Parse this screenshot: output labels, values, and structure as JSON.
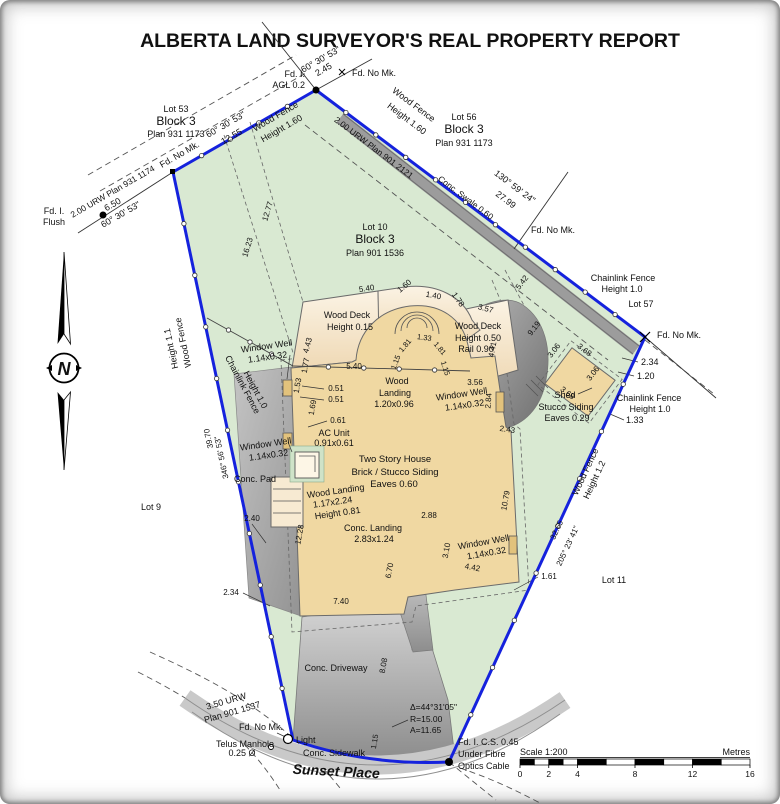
{
  "title": "ALBERTA LAND SURVEYOR'S REAL PROPERTY REPORT",
  "north_arrow": {
    "letter": "N"
  },
  "scale_bar": {
    "label": "Scale 1:200",
    "units": "Metres",
    "ticks": [
      {
        "label": "0",
        "m": 0
      },
      {
        "label": "2",
        "m": 2
      },
      {
        "label": "4",
        "m": 4
      },
      {
        "label": "8",
        "m": 8
      },
      {
        "label": "12",
        "m": 12
      },
      {
        "label": "16",
        "m": 16
      }
    ]
  },
  "colors": {
    "boundary_blue": "#1522dd",
    "parcel_green": "#d9e9d2",
    "house_tan": "#f0d8a2",
    "deck_tan": "#f7ead2",
    "window_well_tan": "#e2c27c",
    "concrete_gray": "#b9b9b9",
    "swale_gray": "#9c9c9c"
  },
  "labels": [
    {
      "id": "fd-i-agl-1",
      "text": "Fd. I.",
      "x": 305,
      "y": 77,
      "anchor": "end"
    },
    {
      "id": "fd-i-agl-2",
      "text": "AGL 0.2",
      "x": 305,
      "y": 88,
      "anchor": "end"
    },
    {
      "id": "tie-bearing",
      "text": "60° 30' 53\"",
      "x": 322,
      "y": 62,
      "rot": -30
    },
    {
      "id": "tie-dist",
      "text": "2.45",
      "x": 325,
      "y": 72,
      "rot": -30
    },
    {
      "id": "fd-no-mk-top",
      "text": "Fd. No Mk.",
      "x": 352,
      "y": 76,
      "anchor": "start"
    },
    {
      "id": "lot53-name",
      "text": "Lot 53",
      "x": 176,
      "y": 112
    },
    {
      "id": "lot53-block",
      "text": "Block 3",
      "x": 176,
      "y": 125,
      "size": 12
    },
    {
      "id": "lot53-plan",
      "text": "Plan 931 1173",
      "x": 176,
      "y": 137
    },
    {
      "id": "nw-bearing",
      "text": "60° 30' 53\"",
      "x": 227,
      "y": 127,
      "rot": -30
    },
    {
      "id": "nw-dist",
      "text": "12.55",
      "x": 233,
      "y": 139,
      "rot": -30
    },
    {
      "id": "nw-wood-fence-1",
      "text": "Wood Fence",
      "x": 277,
      "y": 119,
      "rot": -30
    },
    {
      "id": "nw-wood-fence-2",
      "text": "Height 1.60",
      "x": 283,
      "y": 131,
      "rot": -30
    },
    {
      "id": "urw-nw",
      "text": "2.00 URW Plan 931 1174",
      "x": 114,
      "y": 194,
      "rot": -30,
      "size": 8.5
    },
    {
      "id": "fd-no-mk-w",
      "text": "Fd. No Mk.",
      "x": 181,
      "y": 157,
      "rot": -30
    },
    {
      "id": "ext-dist",
      "text": "6.50",
      "x": 114,
      "y": 207,
      "rot": -30
    },
    {
      "id": "ext-bearing",
      "text": "60° 30' 53\"",
      "x": 122,
      "y": 217,
      "rot": -30
    },
    {
      "id": "fd-i-flush-1",
      "text": "Fd. I.",
      "x": 54,
      "y": 214
    },
    {
      "id": "fd-i-flush-2",
      "text": "Flush",
      "x": 54,
      "y": 225
    },
    {
      "id": "urw-ne",
      "text": "2.00 URW Plan 901 2121",
      "x": 372,
      "y": 150,
      "rot": 37,
      "size": 8.5
    },
    {
      "id": "ne-wood-fence-1",
      "text": "Wood Fence",
      "x": 412,
      "y": 107,
      "rot": 37
    },
    {
      "id": "ne-wood-fence-2",
      "text": "Height 1.60",
      "x": 405,
      "y": 121,
      "rot": 37
    },
    {
      "id": "lot56-name",
      "text": "Lot 56",
      "x": 464,
      "y": 120
    },
    {
      "id": "lot56-block",
      "text": "Block 3",
      "x": 464,
      "y": 133,
      "size": 12
    },
    {
      "id": "lot56-plan",
      "text": "Plan 931 1173",
      "x": 464,
      "y": 146
    },
    {
      "id": "swale-label",
      "text": "Conc. Swale 0.60",
      "x": 464,
      "y": 200,
      "rot": 37,
      "size": 8.5
    },
    {
      "id": "ne-bearing",
      "text": "130° 59' 24\"",
      "x": 513,
      "y": 189,
      "rot": 37
    },
    {
      "id": "ne-dist",
      "text": "27.99",
      "x": 504,
      "y": 202,
      "rot": 37
    },
    {
      "id": "fd-no-mk-5657",
      "text": "Fd. No Mk.",
      "x": 531,
      "y": 233,
      "anchor": "start"
    },
    {
      "id": "clf-ne-1",
      "text": "Chainlink Fence",
      "x": 623,
      "y": 281
    },
    {
      "id": "clf-ne-2",
      "text": "Height 1.0",
      "x": 622,
      "y": 292
    },
    {
      "id": "lot57",
      "text": "Lot 57",
      "x": 641,
      "y": 307
    },
    {
      "id": "fd-no-mk-e",
      "text": "Fd. No Mk.",
      "x": 657,
      "y": 338,
      "anchor": "start"
    },
    {
      "id": "dim-234e",
      "text": "2.34",
      "x": 641,
      "y": 365,
      "anchor": "start"
    },
    {
      "id": "dim-120",
      "text": "1.20",
      "x": 637,
      "y": 379,
      "anchor": "start"
    },
    {
      "id": "clf-e-1",
      "text": "Chainlink Fence",
      "x": 649,
      "y": 401
    },
    {
      "id": "clf-e-2",
      "text": "Height 1.0",
      "x": 650,
      "y": 412
    },
    {
      "id": "dim-133",
      "text": "1.33",
      "x": 626,
      "y": 423,
      "anchor": "start"
    },
    {
      "id": "shed-1",
      "text": "Shed",
      "x": 565,
      "y": 398
    },
    {
      "id": "shed-2",
      "text": "Stucco Siding",
      "x": 566,
      "y": 410
    },
    {
      "id": "shed-3",
      "text": "Eaves 0.29",
      "x": 567,
      "y": 421
    },
    {
      "id": "shed-d1",
      "text": "3.06",
      "x": 556,
      "y": 352,
      "rot": -53,
      "size": 8
    },
    {
      "id": "shed-d2",
      "text": "3.68",
      "x": 583,
      "y": 352,
      "rot": 37,
      "size": 8
    },
    {
      "id": "shed-d3",
      "text": "3.68",
      "x": 566,
      "y": 395,
      "rot": 37,
      "size": 8
    },
    {
      "id": "shed-d4",
      "text": "3.06",
      "x": 595,
      "y": 375,
      "rot": -53,
      "size": 8
    },
    {
      "id": "wit-542",
      "text": "5.42",
      "x": 524,
      "y": 284,
      "rot": -52,
      "size": 8
    },
    {
      "id": "wit-919",
      "text": "9.19",
      "x": 536,
      "y": 330,
      "rot": -52,
      "size": 8
    },
    {
      "id": "lot10-name",
      "text": "Lot 10",
      "x": 375,
      "y": 230
    },
    {
      "id": "lot10-block",
      "text": "Block 3",
      "x": 375,
      "y": 243,
      "size": 12
    },
    {
      "id": "lot10-plan",
      "text": "Plan 901 1536",
      "x": 375,
      "y": 256
    },
    {
      "id": "wit-1277",
      "text": "12.77",
      "x": 270,
      "y": 212,
      "rot": -73,
      "size": 8
    },
    {
      "id": "wit-1623",
      "text": "16.23",
      "x": 250,
      "y": 248,
      "rot": -73,
      "size": 8
    },
    {
      "id": "deck-540",
      "text": "5.40",
      "x": 367,
      "y": 291,
      "rot": -8,
      "size": 8
    },
    {
      "id": "deck-160",
      "text": "1.60",
      "x": 406,
      "y": 288,
      "rot": -40,
      "size": 8
    },
    {
      "id": "deck-140",
      "text": "1.40",
      "x": 433,
      "y": 298,
      "rot": 10,
      "size": 8
    },
    {
      "id": "deck-178",
      "text": "1.78",
      "x": 456,
      "y": 301,
      "rot": 55,
      "size": 8
    },
    {
      "id": "deck-357",
      "text": "3.57",
      "x": 485,
      "y": 311,
      "rot": 15,
      "size": 8
    },
    {
      "id": "deck-443",
      "text": "4.43",
      "x": 310,
      "y": 346,
      "rot": -75,
      "size": 8
    },
    {
      "id": "wood-deck-l1",
      "text": "Wood Deck",
      "x": 347,
      "y": 318
    },
    {
      "id": "wood-deck-l2",
      "text": "Height 0.15",
      "x": 350,
      "y": 330
    },
    {
      "id": "wood-deck-r1",
      "text": "Wood Deck",
      "x": 478,
      "y": 329
    },
    {
      "id": "wood-deck-r2",
      "text": "Height 0.50",
      "x": 478,
      "y": 341
    },
    {
      "id": "wood-deck-r3",
      "text": "Rail 0.90",
      "x": 476,
      "y": 352
    },
    {
      "id": "dim-441",
      "text": "4.41",
      "x": 495,
      "y": 350,
      "rot": -80,
      "size": 8
    },
    {
      "id": "dim-177",
      "text": "1.77",
      "x": 308,
      "y": 366,
      "rot": -80,
      "size": 8
    },
    {
      "id": "dim-540b",
      "text": "5.40",
      "x": 354,
      "y": 369,
      "size": 8
    },
    {
      "id": "arch-115a",
      "text": "1.15",
      "x": 398,
      "y": 363,
      "rot": -70,
      "size": 7.5
    },
    {
      "id": "arch-181a",
      "text": "1.81",
      "x": 407,
      "y": 347,
      "rot": -50,
      "size": 7.5
    },
    {
      "id": "arch-133",
      "text": "1.33",
      "x": 424,
      "y": 340,
      "rot": 8,
      "size": 7.5
    },
    {
      "id": "arch-181b",
      "text": "1.81",
      "x": 438,
      "y": 350,
      "rot": 50,
      "size": 7.5
    },
    {
      "id": "arch-115b",
      "text": "1.15",
      "x": 443,
      "y": 369,
      "rot": 72,
      "size": 7.5
    },
    {
      "id": "wood-landing-1",
      "text": "Wood",
      "x": 397,
      "y": 384
    },
    {
      "id": "wood-landing-2",
      "text": "Landing",
      "x": 395,
      "y": 396
    },
    {
      "id": "wood-landing-3",
      "text": "1.20x0.96",
      "x": 394,
      "y": 407
    },
    {
      "id": "dim-356",
      "text": "3.56",
      "x": 475,
      "y": 385,
      "size": 8
    },
    {
      "id": "ww-r1",
      "text": "Window Well",
      "x": 462,
      "y": 397,
      "rot": -8
    },
    {
      "id": "ww-r2",
      "text": "1.14x0.32",
      "x": 465,
      "y": 408,
      "rot": -8
    },
    {
      "id": "dim-284",
      "text": "2.84",
      "x": 491,
      "y": 401,
      "rot": -85,
      "size": 8
    },
    {
      "id": "dim-243",
      "text": "2.43",
      "x": 507,
      "y": 432,
      "rot": 8,
      "size": 8
    },
    {
      "id": "dim-153",
      "text": "1.53",
      "x": 300,
      "y": 386,
      "rot": -80,
      "size": 8
    },
    {
      "id": "dim-051a",
      "text": "0.51",
      "x": 336,
      "y": 391,
      "size": 8
    },
    {
      "id": "dim-051b",
      "text": "0.51",
      "x": 336,
      "y": 402,
      "size": 8
    },
    {
      "id": "dim-169",
      "text": "1.69",
      "x": 315,
      "y": 408,
      "rot": -80,
      "size": 8
    },
    {
      "id": "dim-061",
      "text": "0.61",
      "x": 338,
      "y": 423,
      "size": 8
    },
    {
      "id": "ac-unit-1",
      "text": "AC Unit",
      "x": 334,
      "y": 436
    },
    {
      "id": "ac-unit-2",
      "text": "0.91x0.61",
      "x": 334,
      "y": 446
    },
    {
      "id": "ww-l1a",
      "text": "Window Well",
      "x": 267,
      "y": 349,
      "rot": -8
    },
    {
      "id": "ww-l1b",
      "text": "1.14x0.32",
      "x": 268,
      "y": 360,
      "rot": -8
    },
    {
      "id": "clf-w-1",
      "text": "Chainlink Fence",
      "x": 240,
      "y": 386,
      "rot": 62
    },
    {
      "id": "clf-w-2",
      "text": "Height 1.0",
      "x": 253,
      "y": 391,
      "rot": 62
    },
    {
      "id": "ww-l2a",
      "text": "Window Well",
      "x": 266,
      "y": 447,
      "rot": -8
    },
    {
      "id": "ww-l2b",
      "text": "1.14x0.32",
      "x": 269,
      "y": 458,
      "rot": -8
    },
    {
      "id": "w-wood-fence-1",
      "text": "Wood Fence",
      "x": 186,
      "y": 342,
      "rot": -102
    },
    {
      "id": "w-wood-fence-2",
      "text": "Height 1.1",
      "x": 174,
      "y": 348,
      "rot": -102
    },
    {
      "id": "house-1",
      "text": "Two Story House",
      "x": 395,
      "y": 462,
      "size": 9.5
    },
    {
      "id": "house-2",
      "text": "Brick / Stucco Siding",
      "x": 395,
      "y": 475,
      "size": 9.5
    },
    {
      "id": "house-3",
      "text": "Eaves 0.60",
      "x": 394,
      "y": 487,
      "size": 9.5
    },
    {
      "id": "wld-1",
      "text": "Wood Landing",
      "x": 336,
      "y": 494,
      "rot": -8
    },
    {
      "id": "wld-2",
      "text": "1.17x2.24",
      "x": 333,
      "y": 505,
      "rot": -8
    },
    {
      "id": "wld-3",
      "text": "Height 0.81",
      "x": 338,
      "y": 516,
      "rot": -8
    },
    {
      "id": "conc-pad",
      "text": "Conc. Pad",
      "x": 255,
      "y": 482
    },
    {
      "id": "w-dist",
      "text": "39.70",
      "x": 211,
      "y": 438,
      "rot": -102,
      "size": 8
    },
    {
      "id": "w-bearing",
      "text": "346° 56' 53\"",
      "x": 224,
      "y": 457,
      "rot": -102,
      "size": 8
    },
    {
      "id": "lot9",
      "text": "Lot 9",
      "x": 151,
      "y": 510
    },
    {
      "id": "dim-240",
      "text": "2.40",
      "x": 252,
      "y": 521,
      "size": 8
    },
    {
      "id": "dim-1228",
      "text": "12.28",
      "x": 302,
      "y": 535,
      "rot": -80,
      "size": 8
    },
    {
      "id": "conc-landing-1",
      "text": "Conc. Landing",
      "x": 373,
      "y": 531
    },
    {
      "id": "conc-landing-2",
      "text": "2.83x1.24",
      "x": 374,
      "y": 542
    },
    {
      "id": "dim-288",
      "text": "2.88",
      "x": 429,
      "y": 518,
      "size": 8
    },
    {
      "id": "dim-310",
      "text": "3.10",
      "x": 449,
      "y": 551,
      "rot": -80,
      "size": 8
    },
    {
      "id": "ww-b1",
      "text": "Window Well",
      "x": 484,
      "y": 545,
      "rot": -10
    },
    {
      "id": "ww-b2",
      "text": "1.14x0.32",
      "x": 487,
      "y": 556,
      "rot": -10
    },
    {
      "id": "dim-442",
      "text": "4.42",
      "x": 472,
      "y": 570,
      "rot": 10,
      "size": 8
    },
    {
      "id": "dim-1079",
      "text": "10.79",
      "x": 508,
      "y": 501,
      "rot": -80,
      "size": 8
    },
    {
      "id": "dim-670",
      "text": "6.70",
      "x": 392,
      "y": 571,
      "rot": -80,
      "size": 8
    },
    {
      "id": "dim-740",
      "text": "7.40",
      "x": 341,
      "y": 604,
      "size": 8
    },
    {
      "id": "dim-234w",
      "text": "2.34",
      "x": 231,
      "y": 595,
      "size": 8
    },
    {
      "id": "dim-161",
      "text": "1.61",
      "x": 549,
      "y": 579,
      "size": 8
    },
    {
      "id": "e-dist",
      "text": "32.65",
      "x": 559,
      "y": 531,
      "rot": -65,
      "size": 8
    },
    {
      "id": "e-bearing",
      "text": "205° 23' 41\"",
      "x": 570,
      "y": 547,
      "rot": -65,
      "size": 8
    },
    {
      "id": "e-wood-fence-1",
      "text": "Wood Fence",
      "x": 588,
      "y": 473,
      "rot": -65
    },
    {
      "id": "e-wood-fence-2",
      "text": "Height 1.2",
      "x": 597,
      "y": 481,
      "rot": -65
    },
    {
      "id": "lot11",
      "text": "Lot 11",
      "x": 614,
      "y": 583
    },
    {
      "id": "conc-driveway",
      "text": "Conc. Driveway",
      "x": 336,
      "y": 671
    },
    {
      "id": "dim-808",
      "text": "8.08",
      "x": 386,
      "y": 666,
      "rot": -80,
      "size": 8
    },
    {
      "id": "urw-s1",
      "text": "3.50 URW",
      "x": 227,
      "y": 704,
      "rot": -16
    },
    {
      "id": "urw-s2",
      "text": "Plan 901 1537",
      "x": 233,
      "y": 715,
      "rot": -16
    },
    {
      "id": "fd-no-mk-s",
      "text": "Fd. No Mk.",
      "x": 261,
      "y": 730
    },
    {
      "id": "light-label",
      "text": "Light",
      "x": 296,
      "y": 743,
      "anchor": "start"
    },
    {
      "id": "telus-1",
      "text": "Telus Manhole",
      "x": 245,
      "y": 747
    },
    {
      "id": "telus-2",
      "text": "0.25 Ø",
      "x": 242,
      "y": 756
    },
    {
      "id": "conc-sidewalk",
      "text": "Conc. Sidewalk",
      "x": 334,
      "y": 756
    },
    {
      "id": "street-name",
      "text": "Sunset Place",
      "x": 336,
      "y": 776,
      "size": 14,
      "fs": "italic",
      "w": "bold",
      "ff": "Liberation Serif, serif",
      "rot": 3
    },
    {
      "id": "curve-delta",
      "text": "Δ=44°31'05\"",
      "x": 410,
      "y": 710,
      "anchor": "start",
      "size": 8.5
    },
    {
      "id": "curve-r",
      "text": "R=15.00",
      "x": 410,
      "y": 722,
      "anchor": "start",
      "size": 8.5
    },
    {
      "id": "curve-a",
      "text": "A=11.65",
      "x": 410,
      "y": 733,
      "anchor": "start",
      "size": 8.5
    },
    {
      "id": "dim-115",
      "text": "1.15",
      "x": 377,
      "y": 742,
      "rot": -80,
      "size": 7.5
    },
    {
      "id": "fics-1",
      "text": "Fd. I. C.S. 0.45",
      "x": 458,
      "y": 745,
      "anchor": "start"
    },
    {
      "id": "fics-2",
      "text": "Under Fibre",
      "x": 458,
      "y": 757,
      "anchor": "start"
    },
    {
      "id": "fics-3",
      "text": "Optics Cable",
      "x": 458,
      "y": 769,
      "anchor": "start"
    }
  ]
}
